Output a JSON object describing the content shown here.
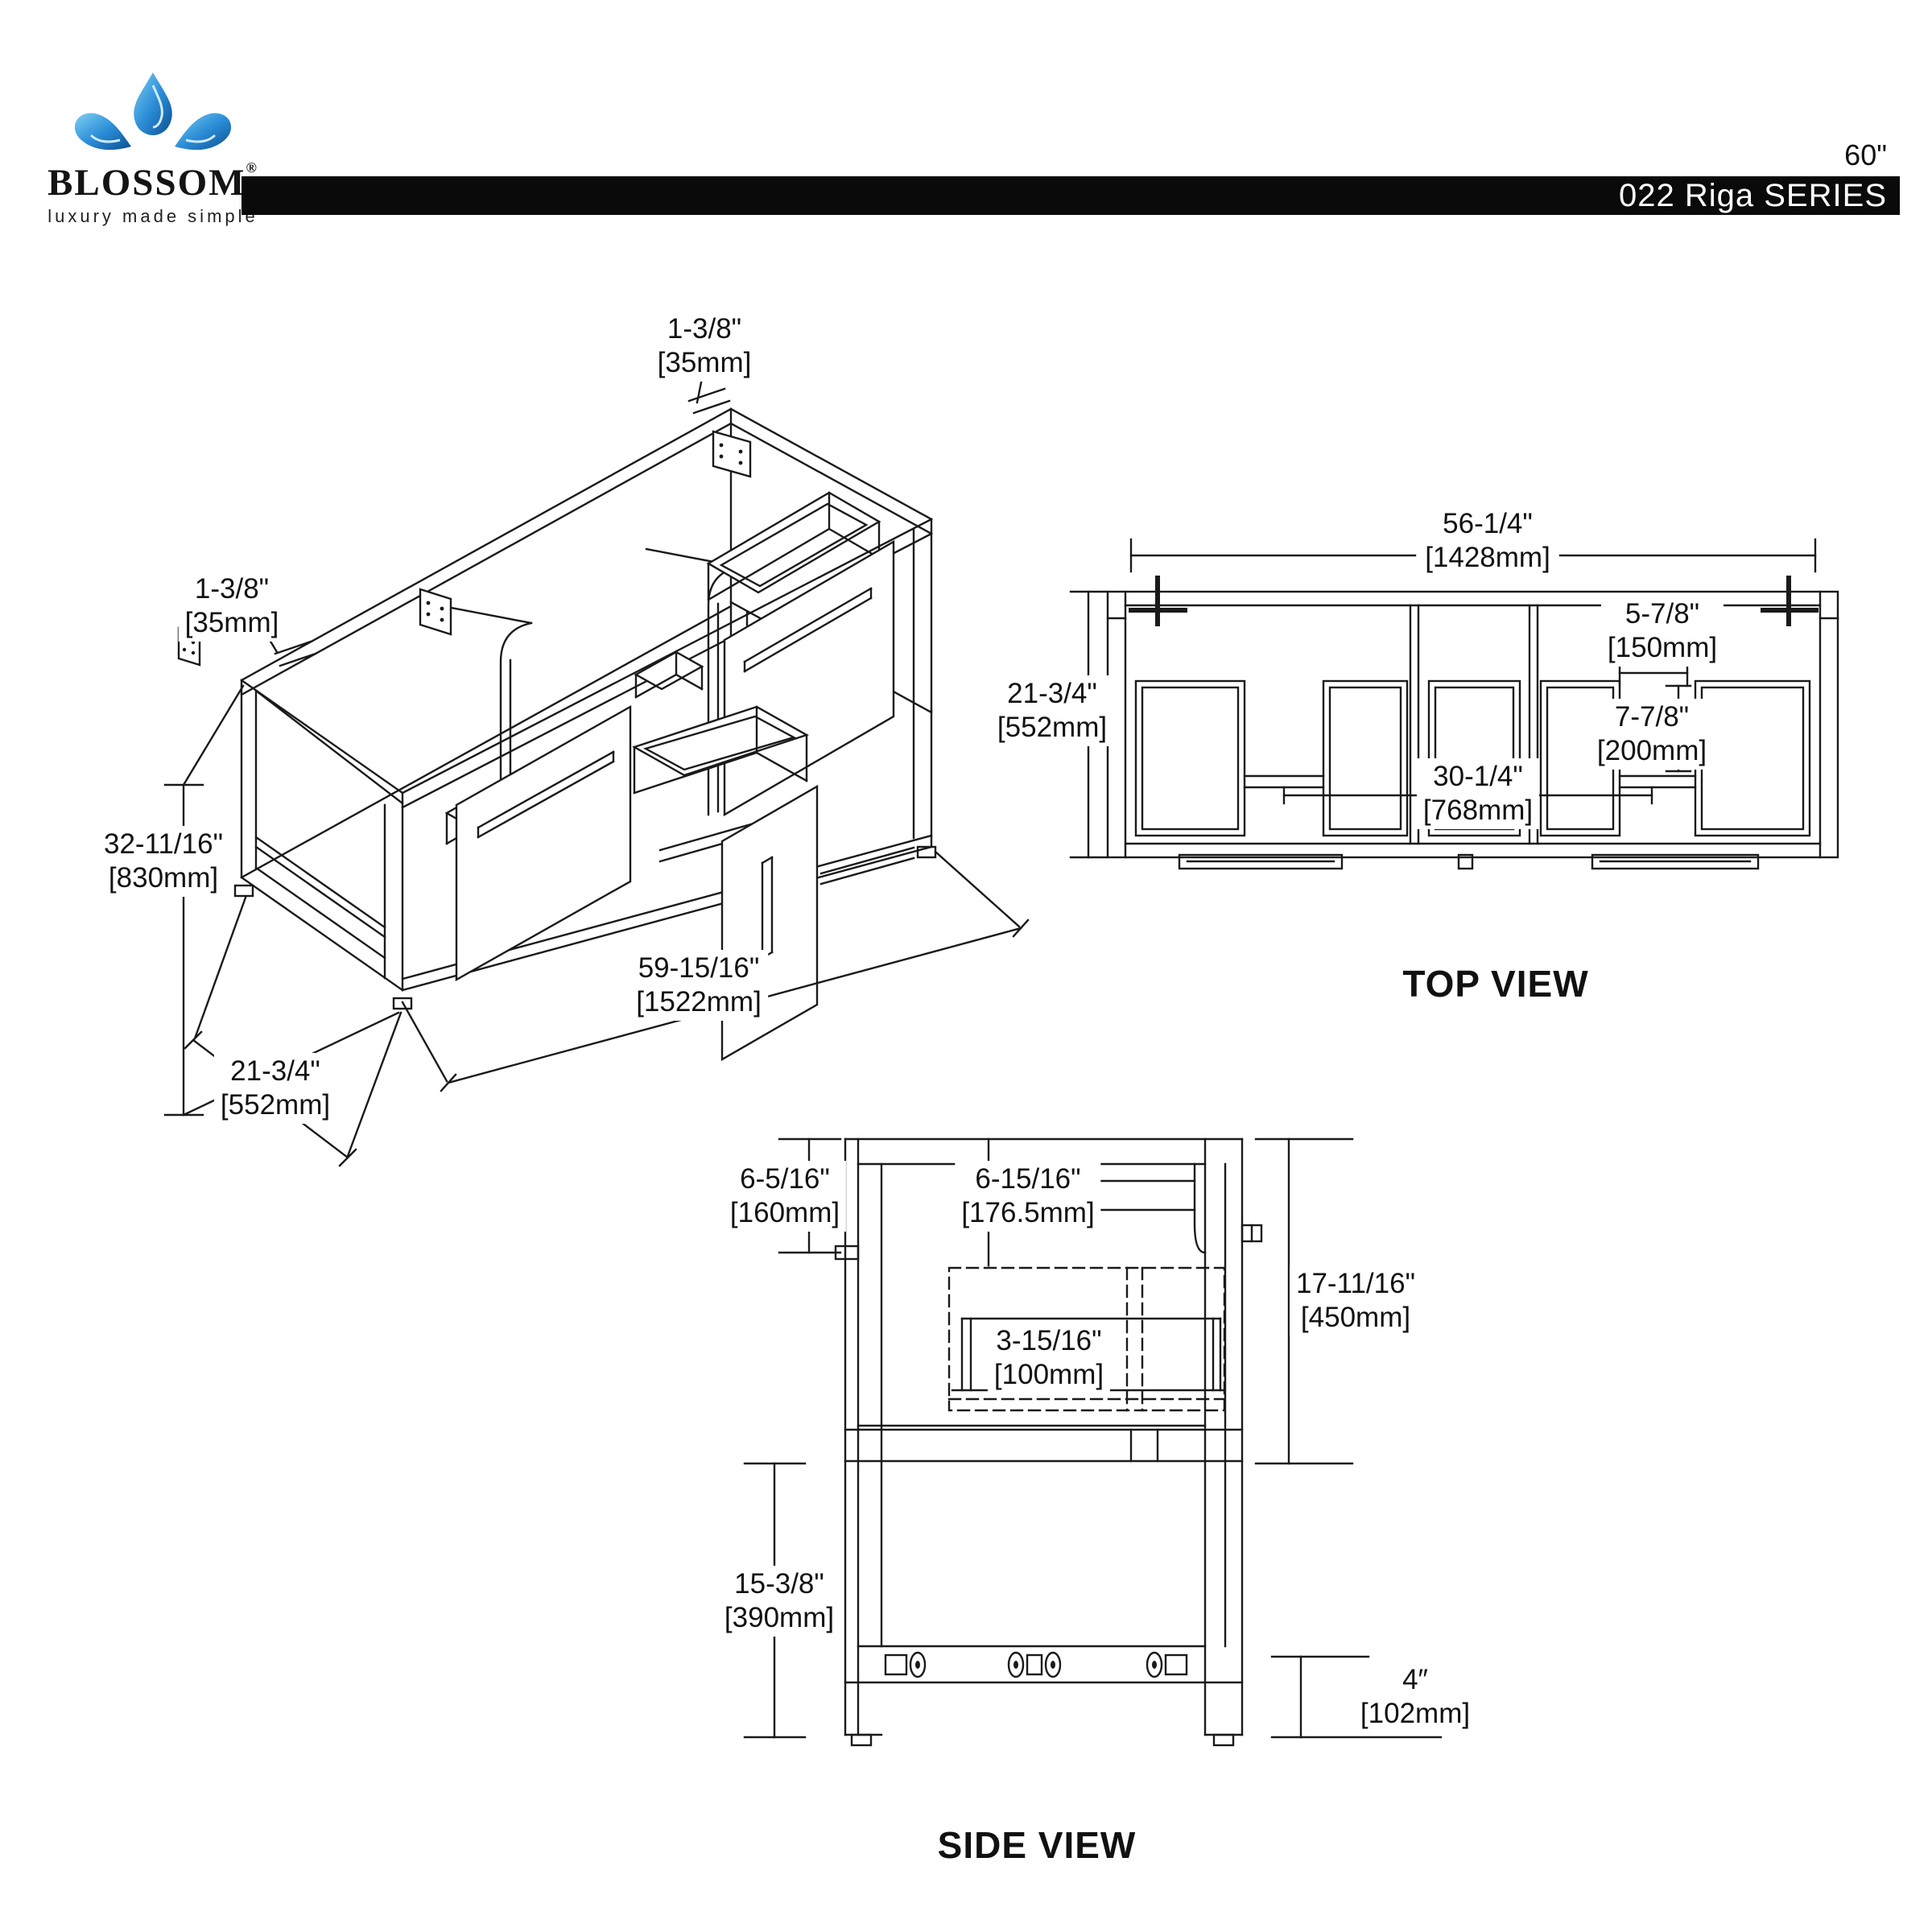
{
  "header": {
    "brand": "BLOSSOM",
    "brand_reg": "®",
    "tagline": "luxury made simple",
    "logo_icon": "blossom-flower-icon",
    "size_label": "60\"",
    "series_label": "022 Riga SERIES"
  },
  "views": {
    "isometric": {
      "dims": {
        "top_thickness": {
          "in": "1-3/8\"",
          "mm": "[35mm]"
        },
        "left_thickness": {
          "in": "1-3/8\"",
          "mm": "[35mm]"
        },
        "height": {
          "in": "32-11/16\"",
          "mm": "[830mm]"
        },
        "width": {
          "in": "59-15/16\"",
          "mm": "[1522mm]"
        },
        "depth": {
          "in": "21-3/4\"",
          "mm": "[552mm]"
        }
      }
    },
    "top": {
      "label": "TOP VIEW",
      "dims": {
        "width": {
          "in": "56-1/4\"",
          "mm": "[1428mm]"
        },
        "depth": {
          "in": "21-3/4\"",
          "mm": "[552mm]"
        },
        "sink_gap": {
          "in": "5-7/8\"",
          "mm": "[150mm]"
        },
        "sink_depth": {
          "in": "7-7/8\"",
          "mm": "[200mm]"
        },
        "center_span": {
          "in": "30-1/4\"",
          "mm": "[768mm]"
        }
      }
    },
    "side": {
      "label": "SIDE VIEW",
      "dims": {
        "backsplash": {
          "in": "6-5/16\"",
          "mm": "[160mm]"
        },
        "top_inset": {
          "in": "6-15/16\"",
          "mm": "[176.5mm]"
        },
        "cabinet_height": {
          "in": "17-11/16\"",
          "mm": "[450mm]"
        },
        "drawer_height": {
          "in": "3-15/16\"",
          "mm": "[100mm]"
        },
        "leg_space": {
          "in": "15-3/8\"",
          "mm": "[390mm]"
        },
        "toe_height": {
          "in": "4″",
          "mm": "[102mm]"
        }
      }
    }
  }
}
